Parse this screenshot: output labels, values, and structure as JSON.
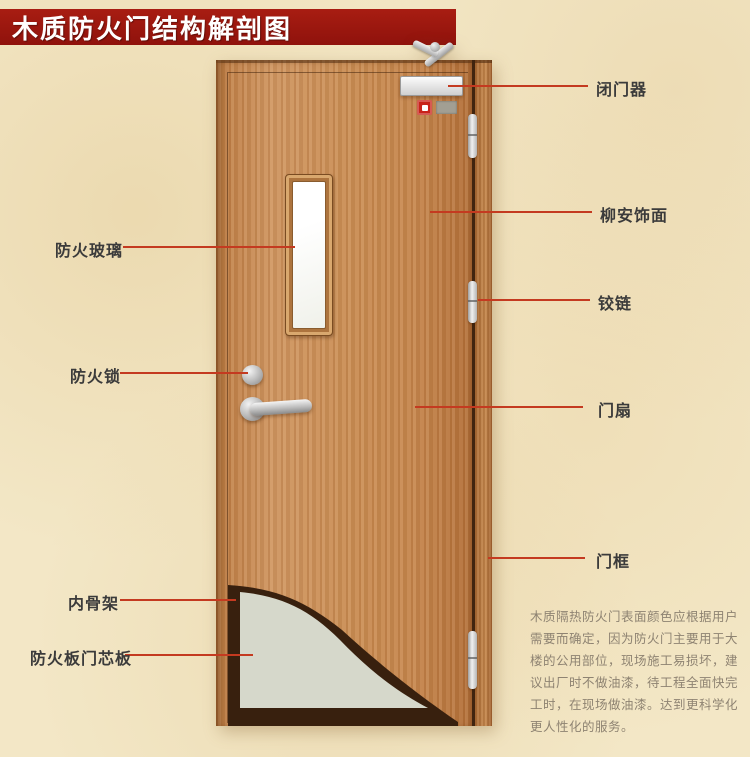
{
  "title": "木质防火门结构解剖图",
  "annotations": {
    "left": [
      {
        "text": "防火玻璃"
      },
      {
        "text": "防火锁"
      },
      {
        "text": "内骨架"
      },
      {
        "text": "防火板门芯板"
      }
    ],
    "right": [
      {
        "text": "闭门器"
      },
      {
        "text": "柳安饰面"
      },
      {
        "text": "铰链"
      },
      {
        "text": "门扇"
      },
      {
        "text": "门框"
      }
    ]
  },
  "description": {
    "lines": [
      "木质隔热防火门表面颜色应根据用户",
      "需要而确定，因为防火门主要用于大",
      "楼的公用部位，现场施工易损坏，建",
      "议出厂时不做油漆，待工程全面快完",
      "工时，在现场做油漆。达到更科学化",
      "更人性化的服务。"
    ]
  },
  "colors": {
    "banner_red": "#9c150e",
    "leader_line": "#c43a20",
    "door_wood": "#c98e57",
    "frame_wood": "#b5793f",
    "core_panel": "#d6d8cb",
    "inner_skeleton": "#38200e",
    "background": "#f3e7c6"
  }
}
